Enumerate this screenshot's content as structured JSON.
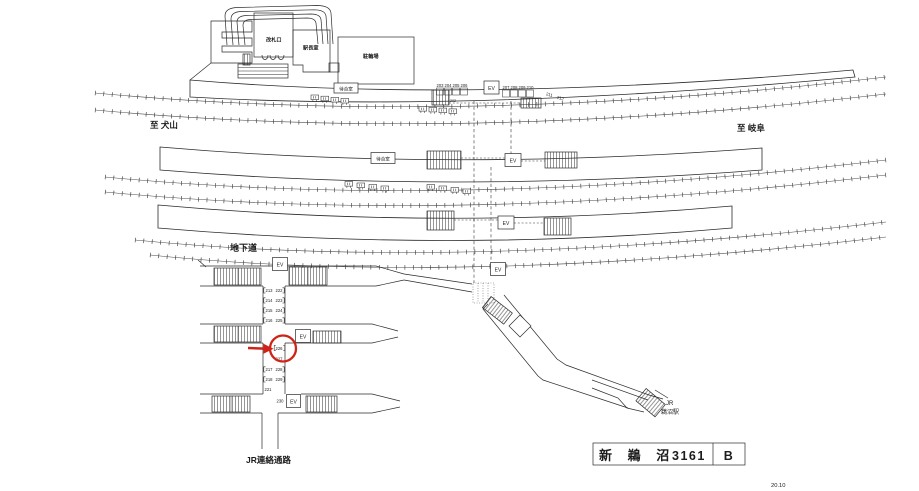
{
  "drawing": {
    "station_name": "新 鵜 沼",
    "drawing_number": "3161",
    "sheet": "B",
    "revision": "20.10"
  },
  "labels": {
    "ticket_gate": "改札口",
    "station_master_office": "駅長室",
    "bicycle_parking": "駐輪場",
    "waiting_room_platform1": "待合室",
    "waiting_room_platform2": "待合室",
    "to_inuyama": "至 犬山",
    "to_gifu": "至 岐阜",
    "underground_passage": "地下道",
    "jr_connecting_passage": "JR連絡通路",
    "jr": "JR",
    "jr_unuma_station": "鵜沼駅",
    "elevator": "EV"
  },
  "sign_numbers": {
    "platform_row_left": [
      "203",
      "204",
      "205",
      "206"
    ],
    "platform_row_right": [
      "207",
      "208",
      "209",
      "210"
    ],
    "platform_slanted": [
      "211",
      "212"
    ],
    "platform_small": "202",
    "corridor_upper_left": [
      "213",
      "214",
      "215",
      "216"
    ],
    "corridor_upper_right": [
      "222",
      "223",
      "224",
      "225"
    ],
    "highlighted": "226",
    "below_highlight": "227",
    "corridor_lower_left": [
      "217",
      "218"
    ],
    "corridor_lower_right": [
      "228",
      "229"
    ],
    "corridor_single": "221",
    "near_elevator": "230"
  },
  "highlight": {
    "color": "#cf2318"
  }
}
